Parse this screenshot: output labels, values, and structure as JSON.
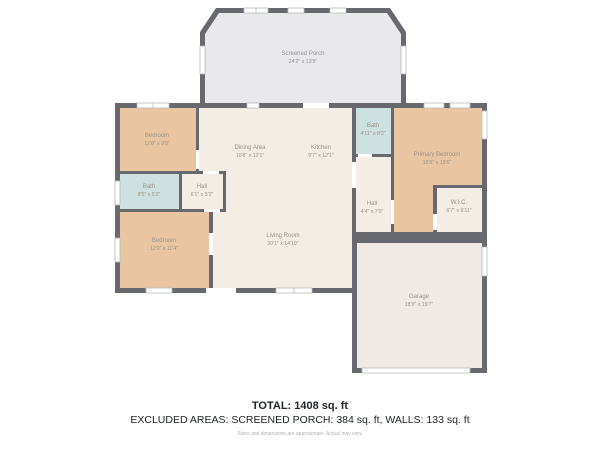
{
  "plan": {
    "title": "Single-story house floor plan",
    "colors": {
      "wall": "#67696e",
      "cream": "#f4ede5",
      "tan": "#e9c6a1",
      "bath": "#cde2e0",
      "porch": "#e9e9eb",
      "garage": "#f1e9e4",
      "label": "#9a9189",
      "porch_label": "#8f9298"
    },
    "rooms": [
      {
        "id": "screened-porch",
        "name": "Screened Porch",
        "dims": "24'2\" x 13'5\""
      },
      {
        "id": "bedroom-top-left",
        "name": "Bedroom",
        "dims": "12'8\" x 9'9\""
      },
      {
        "id": "dining-area",
        "name": "Dining Area",
        "dims": "10'8\" x 12'1\""
      },
      {
        "id": "kitchen",
        "name": "Kitchen",
        "dims": "9'7\" x 12'1\""
      },
      {
        "id": "bath-top",
        "name": "Bath",
        "dims": "4'11\" x 8'2\""
      },
      {
        "id": "primary-bedroom",
        "name": "Primary Bedroom",
        "dims": "15'6\" x 19'6\""
      },
      {
        "id": "bath-left",
        "name": "Bath",
        "dims": "8'5\" x 5'2\""
      },
      {
        "id": "hall-left",
        "name": "Hall",
        "dims": "6'1\" x 5'2\""
      },
      {
        "id": "bedroom-bottom-left",
        "name": "Bedroom",
        "dims": "12'0\" x 11'4\""
      },
      {
        "id": "living-room",
        "name": "Living Room",
        "dims": "20'1\" x 14'10\""
      },
      {
        "id": "hall-right",
        "name": "Hall",
        "dims": "4'4\" x 7'0\""
      },
      {
        "id": "wic",
        "name": "W.I.C.",
        "dims": "6'7\" x 6'11\""
      },
      {
        "id": "garage",
        "name": "Garage",
        "dims": "18'9\" x 19'7\""
      }
    ]
  },
  "summary": {
    "total": "TOTAL: 1408 sq. ft",
    "excluded_areas": "EXCLUDED AREAS: SCREENED PORCH: 384 sq. ft, WALLS: 133 sq. ft",
    "disclaimer": "Sizes and dimensions are approximate. Actual may vary."
  }
}
